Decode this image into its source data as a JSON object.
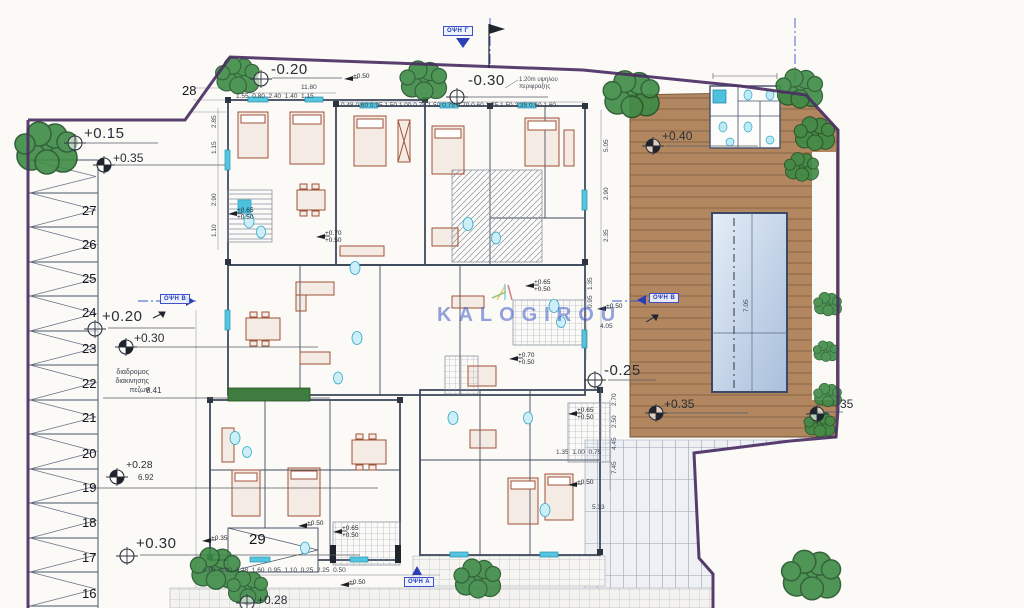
{
  "drawing": {
    "watermark": "KALOGIROU",
    "ramp_label": "29",
    "upper_ramp_label": "28",
    "notes": {
      "fence": "1.20m υψηλου\nπεριφραξης",
      "pedestrian_path": "διαδρομος\nδιακινησης\nπεζων",
      "pedestrian_path_width": "8.41",
      "aisle_width": "6.92",
      "top_total_width": "11.80"
    },
    "view_labels": {
      "top": "ΟΨΗ Γ",
      "left": "ΟΨΗ Β",
      "right": "ΟΨΗ Β",
      "bottom": "ΟΨΗ Α"
    },
    "parking_numbers": [
      "27",
      "26",
      "25",
      "24",
      "23",
      "22",
      "21",
      "20",
      "19",
      "18",
      "17",
      "16"
    ],
    "colors": {
      "boundary": "#4b2f63",
      "walls": "#3f4a5e",
      "deck": "#b28760",
      "pool_light": "#dfe9f4",
      "pool_dark": "#a9bfdb",
      "fixtures": "#4cc2de",
      "trees": "#3c8a44",
      "annotation_blue": "#2b3fb5",
      "furniture": "#a05238"
    },
    "levels": [
      {
        "n": "level-plus015",
        "t": "+0.15",
        "x": 84,
        "y": 126,
        "cls": "lvl-lg",
        "sym": "open",
        "cx": 75,
        "cy": 143
      },
      {
        "n": "level-plus035-upper",
        "t": "+0.35",
        "x": 113,
        "y": 152,
        "cls": "lvl-md",
        "sym": "half",
        "cx": 104,
        "cy": 165
      },
      {
        "n": "level-minus020",
        "t": "-0.20",
        "x": 271,
        "y": 62,
        "cls": "lvl-lg",
        "sym": "open",
        "cx": 261,
        "cy": 79
      },
      {
        "n": "level-minus030",
        "t": "-0.30",
        "x": 468,
        "y": 73,
        "cls": "lvl-lg",
        "sym": "open",
        "cx": 457,
        "cy": 97
      },
      {
        "n": "level-plus040",
        "t": "+0.40",
        "x": 662,
        "y": 130,
        "cls": "lvl-md",
        "sym": "half",
        "cx": 653,
        "cy": 146
      },
      {
        "n": "level-plus020",
        "t": "+0.20",
        "x": 102,
        "y": 309,
        "cls": "lvl-lg",
        "sym": "open",
        "cx": 95,
        "cy": 329
      },
      {
        "n": "level-plus030-left",
        "t": "+0.30",
        "x": 134,
        "y": 332,
        "cls": "lvl-md",
        "sym": "half",
        "cx": 126,
        "cy": 347
      },
      {
        "n": "level-plus028",
        "t": "+0.28",
        "x": 126,
        "y": 460,
        "cls": "lvl-sm",
        "sym": "half",
        "cx": 117,
        "cy": 477
      },
      {
        "n": "level-plus030-bottom",
        "t": "+0.30",
        "x": 136,
        "y": 536,
        "cls": "lvl-lg",
        "sym": "open",
        "cx": 127,
        "cy": 556
      },
      {
        "n": "level-minus025",
        "t": "-0.25",
        "x": 604,
        "y": 363,
        "cls": "lvl-lg",
        "sym": "open",
        "cx": 595,
        "cy": 380
      },
      {
        "n": "level-plus035-deck",
        "t": "+0.35",
        "x": 664,
        "y": 398,
        "cls": "lvl-md",
        "sym": "half",
        "cx": 656,
        "cy": 413
      },
      {
        "n": "level-plus035-right",
        "t": "35",
        "x": 840,
        "y": 398,
        "cls": "lvl-md",
        "sym": "half",
        "cx": 817,
        "cy": 414
      },
      {
        "n": "level-plus028-walk",
        "t": "+0.28",
        "x": 257,
        "y": 594,
        "cls": "lvl-md",
        "sym": "open",
        "cx": 247,
        "cy": 603
      },
      {
        "n": "level-plus050-top",
        "t": "+0.50",
        "x": 353,
        "y": 73,
        "cls": "lvl-xs",
        "sym": "flag",
        "cx": 344,
        "cy": 79
      },
      {
        "n": "level-plus050-right",
        "t": "+0.50",
        "x": 606,
        "y": 303,
        "cls": "lvl-xs",
        "sym": "flag",
        "cx": 597,
        "cy": 309
      },
      {
        "n": "level-plus070-050-a",
        "t": "+0.70\n+0.50",
        "x": 325,
        "y": 230,
        "cls": "lvl-xs",
        "sym": "flag",
        "cx": 316,
        "cy": 237
      },
      {
        "n": "level-plus065-050-a",
        "t": "+0.65\n+0.50",
        "x": 237,
        "y": 207,
        "cls": "lvl-xs",
        "sym": "flag",
        "cx": 228,
        "cy": 214
      },
      {
        "n": "level-plus070-050-b",
        "t": "+0.70\n+0.50",
        "x": 518,
        "y": 352,
        "cls": "lvl-xs",
        "sym": "flag",
        "cx": 509,
        "cy": 359
      },
      {
        "n": "level-plus065-050-b",
        "t": "+0.65\n+0.50",
        "x": 342,
        "y": 525,
        "cls": "lvl-xs",
        "sym": "flag",
        "cx": 333,
        "cy": 532
      },
      {
        "n": "level-plus065-050-c",
        "t": "+0.65\n+0.50",
        "x": 577,
        "y": 407,
        "cls": "lvl-xs",
        "sym": "flag",
        "cx": 568,
        "cy": 414
      },
      {
        "n": "level-plus065-050-d",
        "t": "+0.65\n+0.50",
        "x": 534,
        "y": 279,
        "cls": "lvl-xs",
        "sym": "flag",
        "cx": 525,
        "cy": 286
      },
      {
        "n": "level-plus050-bottom",
        "t": "+0.50",
        "x": 349,
        "y": 579,
        "cls": "lvl-xs",
        "sym": "flag",
        "cx": 340,
        "cy": 585
      },
      {
        "n": "level-plus035-ramp",
        "t": "+0.35",
        "x": 211,
        "y": 535,
        "cls": "lvl-xs",
        "sym": "flag",
        "cx": 202,
        "cy": 541
      },
      {
        "n": "level-plus050-mid",
        "t": "+0.50",
        "x": 307,
        "y": 520,
        "cls": "lvl-xs",
        "sym": "flag",
        "cx": 298,
        "cy": 526
      },
      {
        "n": "level-plus050-br",
        "t": "+0.50",
        "x": 577,
        "y": 479,
        "cls": "lvl-xs",
        "sym": "flag",
        "cx": 568,
        "cy": 485
      }
    ],
    "dims": [
      {
        "n": "dim-top-row1",
        "t": [
          "1.55",
          "0.80",
          "2.40",
          "1.40",
          "1.15"
        ],
        "x": 236,
        "y": 94
      },
      {
        "n": "dim-top-row2",
        "t": [
          "0.48",
          "0.60",
          "0.95",
          "1.50",
          "1.00",
          "0.75",
          "1.50",
          "0.75",
          "0.70",
          "0.60",
          "1.75",
          "1.50",
          "2.35",
          "0.60",
          "1.60"
        ],
        "x": 341,
        "y": 103,
        "j": " "
      },
      {
        "n": "dim-bottom-row",
        "t": [
          "0.60",
          "0.90",
          "2.28",
          "1.60",
          "0.95",
          "1.10",
          "0.25",
          "2.25",
          "0.50"
        ],
        "x": 203,
        "y": 568
      },
      {
        "n": "dim-right-row",
        "t": [
          "1.35",
          "1.00",
          "0.75"
        ],
        "x": 556,
        "y": 450
      },
      {
        "n": "dim-533",
        "t": "5.33",
        "x": 592,
        "y": 505
      },
      {
        "n": "dim-405",
        "t": "4.05",
        "x": 600,
        "y": 324
      },
      {
        "n": "dim-505",
        "t": "5.05",
        "x": 604,
        "y": 152,
        "rot": 1
      },
      {
        "n": "dim-290a",
        "t": "2.90",
        "x": 604,
        "y": 200,
        "rot": 1
      },
      {
        "n": "dim-235",
        "t": "2.35",
        "x": 604,
        "y": 242,
        "rot": 1
      },
      {
        "n": "dim-135",
        "t": "1.35",
        "x": 588,
        "y": 290,
        "rot": 1
      },
      {
        "n": "dim-095",
        "t": "0.95",
        "x": 588,
        "y": 308,
        "rot": 1
      },
      {
        "n": "dim-285",
        "t": "2.85",
        "x": 212,
        "y": 128,
        "rot": 1
      },
      {
        "n": "dim-115",
        "t": "1.15",
        "x": 212,
        "y": 154,
        "rot": 1
      },
      {
        "n": "dim-290b",
        "t": "2.90",
        "x": 212,
        "y": 206,
        "rot": 1
      },
      {
        "n": "dim-110",
        "t": "1.10",
        "x": 212,
        "y": 237,
        "rot": 1
      },
      {
        "n": "dim-270",
        "t": "2.70",
        "x": 612,
        "y": 406,
        "rot": 1
      },
      {
        "n": "dim-250",
        "t": "2.50",
        "x": 612,
        "y": 428,
        "rot": 1
      },
      {
        "n": "dim-445",
        "t": "4.45",
        "x": 612,
        "y": 450,
        "rot": 1
      },
      {
        "n": "dim-745",
        "t": "7.45",
        "x": 612,
        "y": 474,
        "rot": 1
      },
      {
        "n": "dim-pool",
        "t": "7.05",
        "x": 744,
        "y": 312,
        "rot": 1
      }
    ]
  }
}
